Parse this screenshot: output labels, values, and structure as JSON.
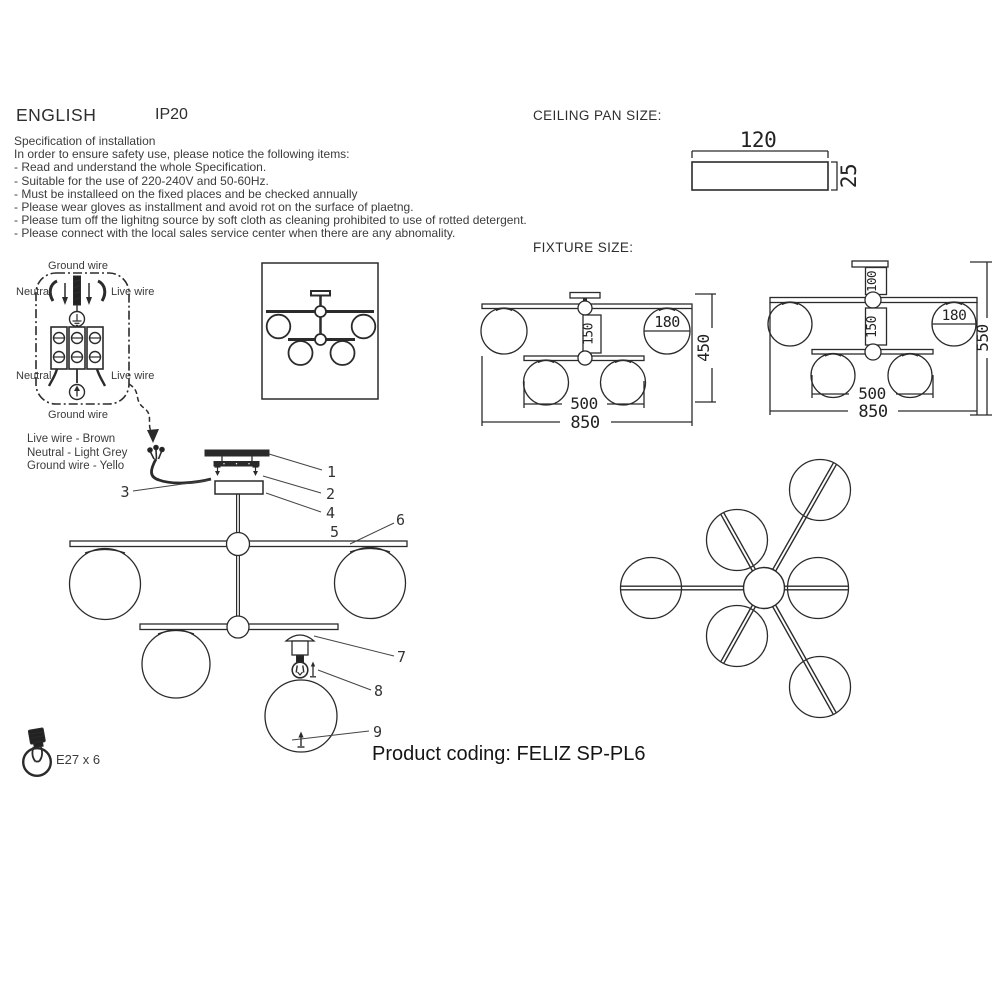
{
  "header": {
    "language": "ENGLISH",
    "ip_rating": "IP20"
  },
  "spec": {
    "title": "Specification of installation",
    "intro": "In order to ensure safety use, please notice the following items:",
    "items": [
      "- Read and understand the whole Specification.",
      "- Suitable for the use of 220-240V and 50-60Hz.",
      "- Must be installeed on the fixed places and be checked annually",
      "- Please wear gloves as installment and avoid rot on the surface of plaetng.",
      "- Please tum off the lighitng source by soft cloth as cleaning prohibited to use of rotted detergent.",
      "- Please connect with the local sales service center when there are any abnomality."
    ]
  },
  "ceiling_pan": {
    "label": "CEILING PAN  SIZE:",
    "width": "120",
    "thickness": "25"
  },
  "fixture_size": {
    "label": "FIXTURE SIZE:",
    "front_view": {
      "rod": "150",
      "globe_diameter": "180",
      "inner_span": "500",
      "outer_span": "850",
      "height": "450"
    },
    "side_view": {
      "top_rod": "100",
      "rod": "150",
      "globe_diameter": "180",
      "inner_span": "500",
      "outer_span": "850",
      "height": "550"
    }
  },
  "wiring_diagram": {
    "ground_top": "Ground wire",
    "neutral_top": "Neutral",
    "live_top": "Live wire",
    "neutral_bottom": "Neutral",
    "live_bottom": "Live wire",
    "ground_bottom": "Ground wire"
  },
  "wire_legend": {
    "live": "Live wire - Brown",
    "neutral": "Neutral - Light Grey",
    "ground": "Ground wire - Yello"
  },
  "assembly": {
    "parts": [
      "1",
      "2",
      "3",
      "4",
      "5",
      "6",
      "7",
      "8",
      "9"
    ]
  },
  "lamp_info": {
    "bulb_spec": "E27 x 6"
  },
  "footer": {
    "product_coding": "Product coding: FELIZ SP-PL6"
  },
  "colors": {
    "line": "#2b2b2b",
    "text": "#3a3a3a",
    "accent_red": "#c5312b"
  }
}
